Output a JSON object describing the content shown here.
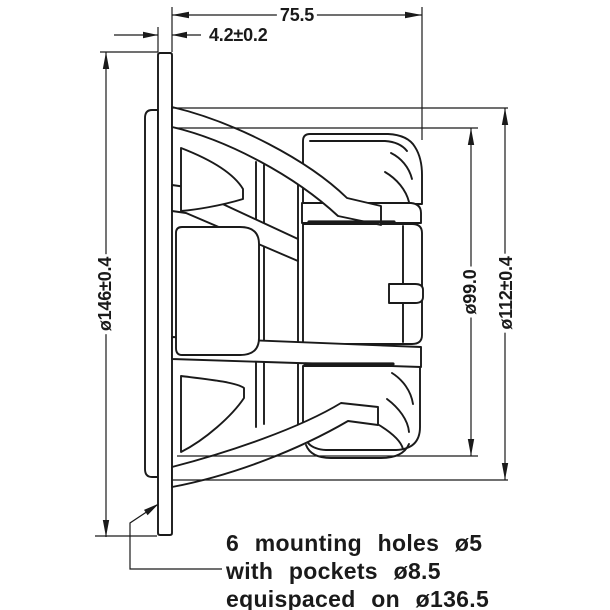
{
  "drawing": {
    "dim_depth": "75.5",
    "dim_flange_thickness": "4.2±0.2",
    "dim_front_diameter": "ø146±0.4",
    "dim_magnet_diameter": "ø99.0",
    "dim_basket_diameter": "ø112±0.4",
    "note_line1": "6 mounting holes ø5",
    "note_line2": "with pockets ø8.5",
    "note_line3": "equispaced on ø136.5",
    "colors": {
      "line": "#1a1a1a",
      "background": "#ffffff"
    }
  }
}
